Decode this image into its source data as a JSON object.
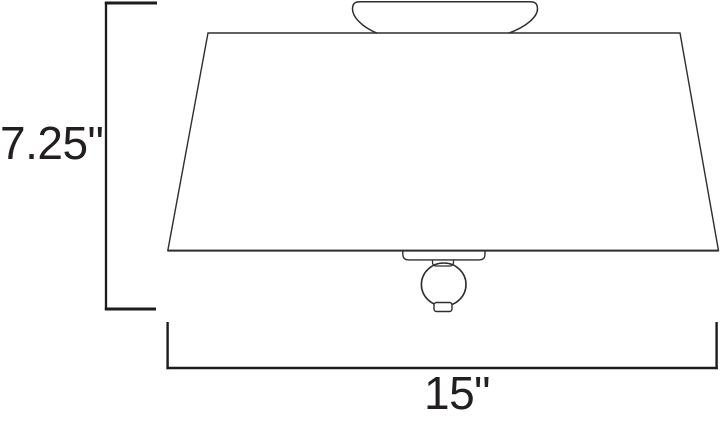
{
  "diagram": {
    "kind": "product-dimension-line-drawing",
    "background_color": "#ffffff",
    "outline_color": "#2e2e2e",
    "dimension_line_color": "#1c1c1c",
    "text_color": "#231f20",
    "height_dimension": {
      "label": "7.25\""
    },
    "width_dimension": {
      "label": "15\""
    }
  }
}
